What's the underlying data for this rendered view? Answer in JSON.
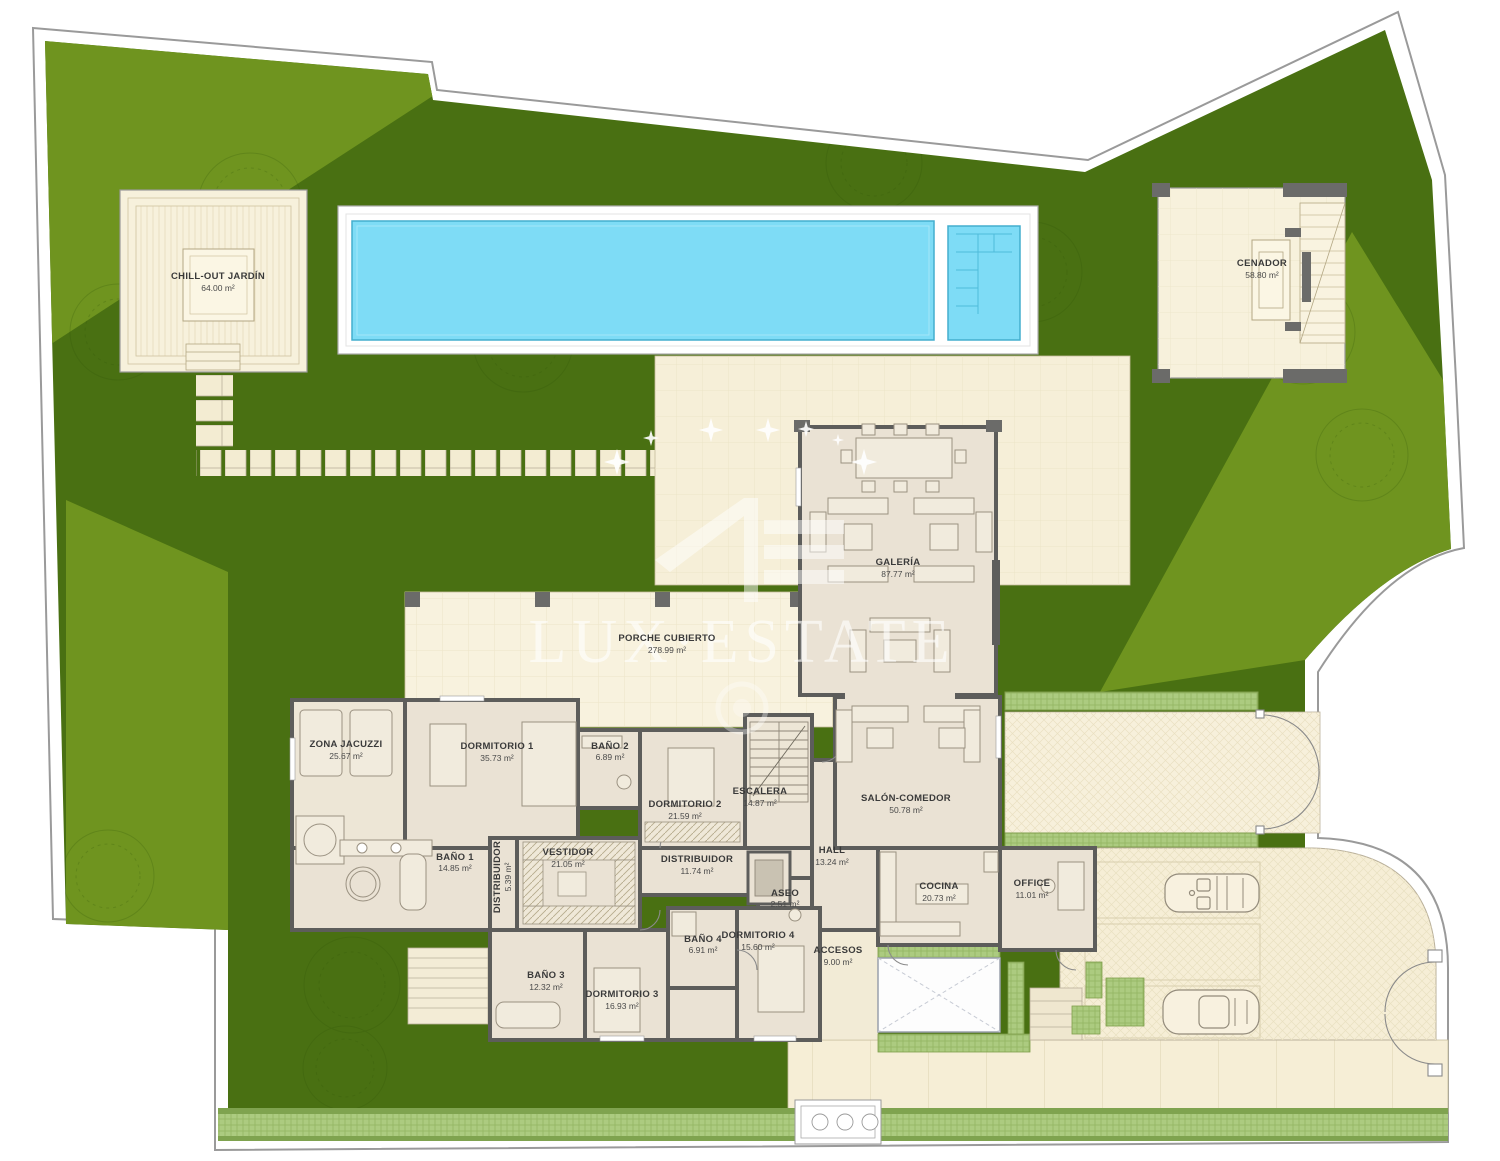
{
  "watermark": {
    "brand": "LUX·ESTATE"
  },
  "rooms": [
    {
      "name": "CHILL-OUT JARDÍN",
      "area": "64.00 m²"
    },
    {
      "name": "CENADOR",
      "area": "58.80 m²"
    },
    {
      "name": "GALERÍA",
      "area": "87.77 m²"
    },
    {
      "name": "PORCHE CUBIERTO",
      "area": "278.99 m²"
    },
    {
      "name": "ZONA JACUZZI",
      "area": "25.67 m²"
    },
    {
      "name": "DORMITORIO 1",
      "area": "35.73 m²"
    },
    {
      "name": "BAÑO 2",
      "area": "6.89 m²"
    },
    {
      "name": "DORMITORIO 2",
      "area": "21.59 m²"
    },
    {
      "name": "ESCALERA",
      "area": "14.87 m²"
    },
    {
      "name": "SALÓN-COMEDOR",
      "area": "50.78 m²"
    },
    {
      "name": "BAÑO 1",
      "area": "14.85 m²"
    },
    {
      "name": "DISTRIBUIDOR",
      "area": "5.39 m²"
    },
    {
      "name": "VESTIDOR",
      "area": "21.05 m²"
    },
    {
      "name": "DISTRIBUIDOR",
      "area": "11.74 m²"
    },
    {
      "name": "HALL",
      "area": "13.24 m²"
    },
    {
      "name": "ASEO",
      "area": "2.51 m²"
    },
    {
      "name": "COCINA",
      "area": "20.73 m²"
    },
    {
      "name": "OFFICE",
      "area": "11.01 m²"
    },
    {
      "name": "BAÑO 4",
      "area": "6.91 m²"
    },
    {
      "name": "DORMITORIO 4",
      "area": "15.60 m²"
    },
    {
      "name": "ACCESOS",
      "area": "9.00 m²"
    },
    {
      "name": "BAÑO 3",
      "area": "12.32 m²"
    },
    {
      "name": "DORMITORIO 3",
      "area": "16.93 m²"
    }
  ],
  "colors": {
    "grass_dark": "#497012",
    "grass_light": "#6F941F",
    "pool_water": "#7EDCF6",
    "terrace": "#F6EFD8",
    "wall": "#5D5D5B",
    "hedge": "#ACCB80"
  }
}
